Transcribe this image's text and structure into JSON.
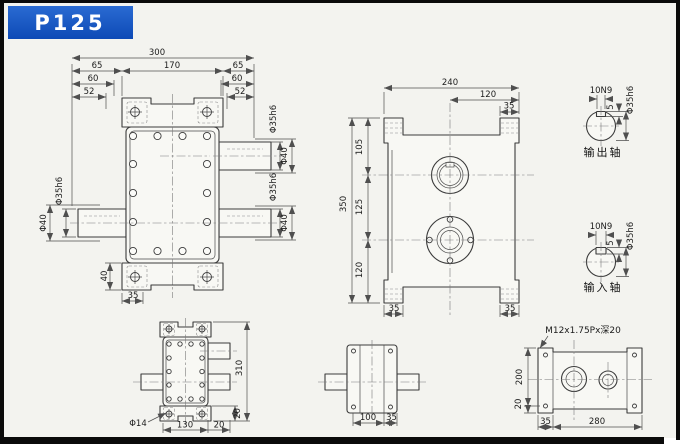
{
  "title": "P125",
  "colors": {
    "title_bg": "#1257c4",
    "paper": "#f3f3ef",
    "line": "#3b3b3b"
  },
  "labels": {
    "shaft_dia": "Φ35h6",
    "hub_dia": "Φ40",
    "keyway": "10N9",
    "key_depth": "5",
    "output_shaft": "输出轴",
    "input_shaft": "输入轴",
    "thread_spec": "M12x1.75Px深20",
    "foot_hole_dia": "Φ14"
  },
  "front_view": {
    "total": "300",
    "side": "65",
    "body": "170",
    "dim60": "60",
    "dim52": "52",
    "foot_h": "40",
    "foot_w": "35"
  },
  "side_view": {
    "width": "240",
    "half": "120",
    "tab": "35",
    "height": "350",
    "seg_top": "105",
    "seg_mid": "125",
    "seg_bot": "120"
  },
  "plan_view": {
    "height": "310",
    "body": "130",
    "shaft": "20",
    "foot": "20"
  },
  "end_view": {
    "body": "100",
    "flange": "35"
  },
  "base_view": {
    "height": "200",
    "foot": "20",
    "offset": "35",
    "span": "280"
  }
}
